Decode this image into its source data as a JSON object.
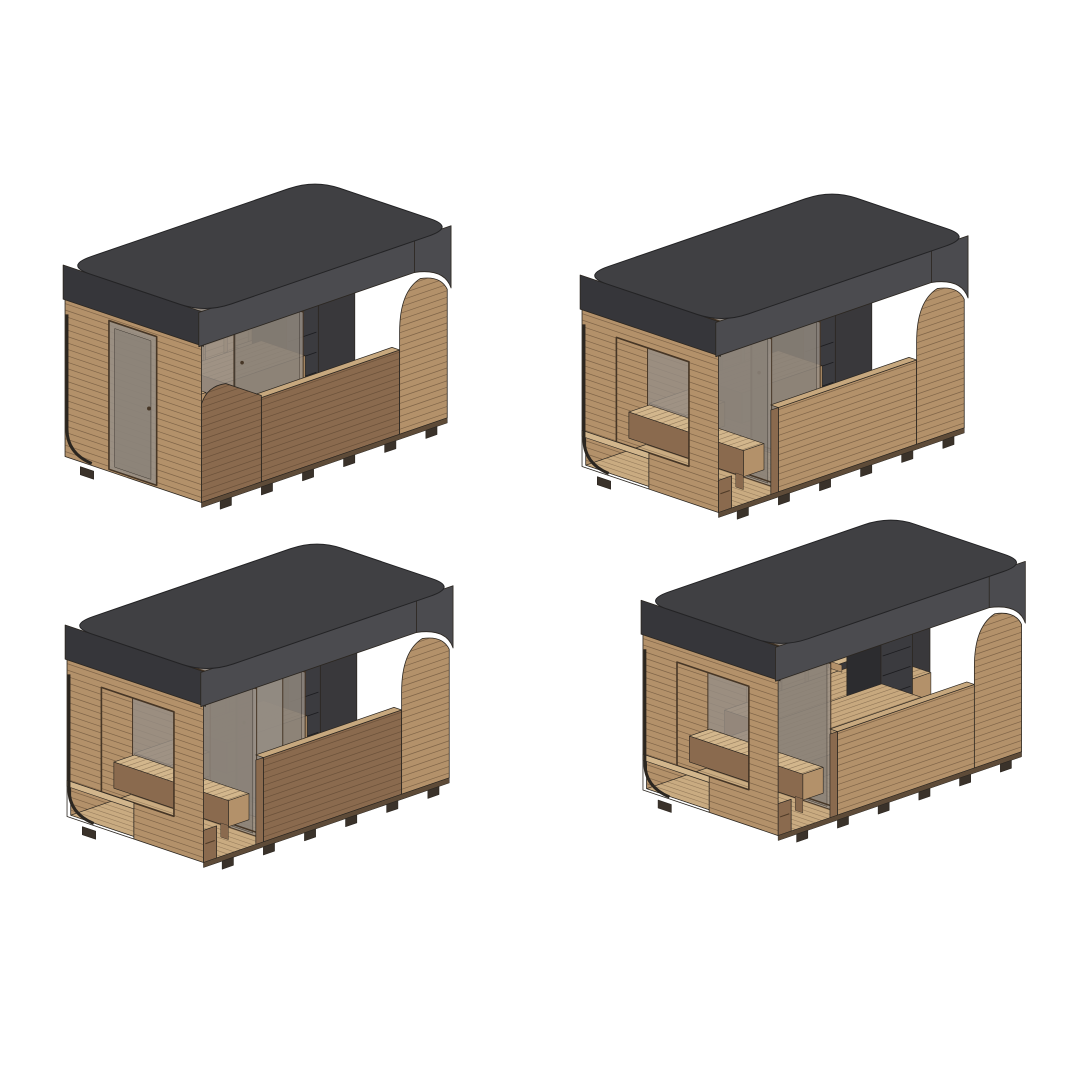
{
  "page": {
    "background": "#ffffff",
    "content": "four isometric cutaway 3D renders of rectangular outdoor sauna cabins arranged in a 2x2 grid"
  },
  "colors": {
    "outline": "#2b2620",
    "wood_light": "#c7a87e",
    "wood_mid": "#b3916a",
    "wood_dark": "#8a6a4e",
    "wood_light2": "#d2b68c",
    "wood_floor": "#c9ab81",
    "slat": "#4e3a27",
    "ceiling_dark": "#3e3d40",
    "panel_dark": "#39383b",
    "roof_top": "#404043",
    "roof_side": "#4b4b4f",
    "roof_side_dark": "#36363a",
    "glass": "#968e85",
    "glass_dark": "#7f776e",
    "frame_dark": "#463626",
    "heater_side": "#2c2c2f",
    "heater_front": "#3b3b3f",
    "heater_top": "#232326",
    "stone_dark": "#1a1a1d",
    "stone_mid": "#3f3f45",
    "porch_shadow": "#544b41",
    "feet": "#3a322a",
    "base_rail": "#5e4b38"
  },
  "figures": [
    {
      "name": "sauna-cabin-render-closed-front",
      "grid_position": "top-left",
      "features": {
        "porch": false,
        "end_door": true,
        "partitions": [
          118
        ],
        "extra_glass": false,
        "long_bench": false,
        "front_tone": "dark"
      }
    },
    {
      "name": "sauna-cabin-render-front-porch",
      "grid_position": "top-right",
      "features": {
        "porch": true,
        "end_door": false,
        "partitions": [
          118
        ],
        "extra_glass": false,
        "long_bench": false,
        "front_tone": "mid"
      }
    },
    {
      "name": "sauna-cabin-render-porch-two-glass-walls",
      "grid_position": "bottom-left",
      "features": {
        "porch": true,
        "end_door": false,
        "partitions": [
          118
        ],
        "extra_glass": true,
        "long_bench": false,
        "front_tone": "dark"
      }
    },
    {
      "name": "sauna-cabin-render-porch-long-bench",
      "grid_position": "bottom-right",
      "features": {
        "porch": true,
        "end_door": false,
        "partitions": [],
        "extra_glass": false,
        "long_bench": true,
        "front_tone": "mid"
      }
    }
  ]
}
